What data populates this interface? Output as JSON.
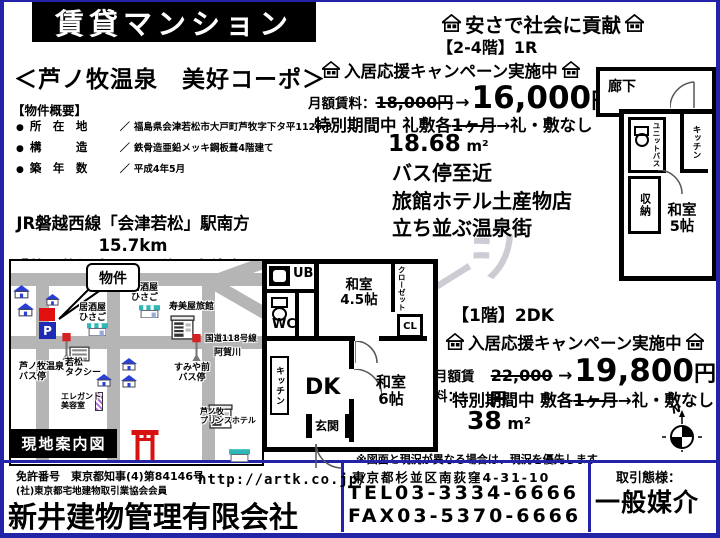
{
  "colors": {
    "navy": "#2323a8",
    "red": "#e01010",
    "road_gray": "#b5b5b5",
    "roof_blue": "#2a3fd4",
    "parking_blue": "#1f2bb5"
  },
  "header": {
    "banner": "賃貸マンション",
    "property_name": "＜芦ノ牧温泉　美好コーポ＞"
  },
  "overview": {
    "heading": "【物件概要】",
    "rows": [
      {
        "bullet": "●",
        "label": "所　在　地",
        "sep": "／",
        "value": "福島県会津若松市大戸町芦牧字下タ平1126-3"
      },
      {
        "bullet": "●",
        "label": "構　　　造",
        "sep": "／",
        "value": "鉄骨造亜鉛メッキ鋼板葺4階建て"
      },
      {
        "bullet": "●",
        "label": "築　年　数",
        "sep": "／",
        "value": "平成4年5月"
      }
    ]
  },
  "access": {
    "line1": "JR磐越西線「会津若松」駅南方15.7km",
    "line2": "「芦ノ牧温泉」バス停下車徒歩1分"
  },
  "map": {
    "callout": "物件",
    "parking": "P",
    "caption": "現地案内図",
    "places": {
      "izakaya1": "居酒屋\nひさご",
      "izakaya2": "居酒屋\nひさご",
      "ryokan": "寿美屋旅館",
      "route": "国道118号線",
      "river": "阿賀川",
      "busstop_sumiya": "すみや前\nバス停",
      "busstop_ashinomaki": "芦ノ牧温泉\nバス停",
      "taxi": "若松\nタクシー",
      "salon": "エレガント\n美容室",
      "hotel": "芦ノ牧\nプリンスホテル"
    }
  },
  "unit_1r": {
    "slogan": "安さで社会に貢献",
    "floor": "【2-4階】1R",
    "campaign": "入居応援キャンペーン実施中",
    "rent_label": "月額賃料：",
    "rent_old": "18,000円",
    "arrow": "→",
    "rent_new_amount": "16,000",
    "rent_new_unit": "円",
    "special_before": "特別期間中 礼敷各",
    "special_struck": "1ヶ月",
    "special_after": "→礼・敷なし",
    "area_value": "18.68",
    "area_unit": "m²",
    "features": [
      "バス停至近",
      "旅館ホテル土産物店",
      "立ち並ぶ温泉街"
    ]
  },
  "unit_2dk": {
    "floor": "【1階】2DK",
    "campaign": "入居応援キャンペーン実施中",
    "rent_label": "月額賃料：",
    "rent_old": "22,000円",
    "arrow": "→",
    "rent_new_amount": "19,800",
    "rent_new_unit": "円",
    "special_before": "特別期間中 敷各",
    "special_struck": "1ヶ月",
    "special_after": "→礼・敷なし",
    "area_value": "38",
    "area_unit": "m²"
  },
  "floorplan_2dk": {
    "ub": "UB",
    "wc": "WC",
    "washitsu_45": "和室\n4.5帖",
    "closet": "クローゼット",
    "cl": "CL",
    "kitchen": "キッチン",
    "dk": "DK",
    "washitsu_6": "和室\n6帖",
    "genkan": "玄関"
  },
  "floorplan_1r": {
    "corridor": "廊下",
    "unit_bath": "ユニットバス",
    "kitchen": "キッチン",
    "storage": "収納",
    "washitsu_5": "和室\n5帖"
  },
  "compass": {
    "north": "N"
  },
  "watermark": "ージ",
  "disclaimer": "※図面と現況が異なる場合は、現況を優先します",
  "footer": {
    "license_no": "免許番号　東京都知事(4)第84146号",
    "association": "(社)東京都宅地建物取引業協会会員",
    "company": "新井建物管理有限会社",
    "url": "http://artk.co.jp/",
    "address": "東京都杉並区南荻窪4-31-10",
    "tel": "TEL03-3334-6666",
    "fax": "FAX03-5370-6666",
    "deal_label": "取引態様：",
    "deal_type": "一般媒介"
  }
}
